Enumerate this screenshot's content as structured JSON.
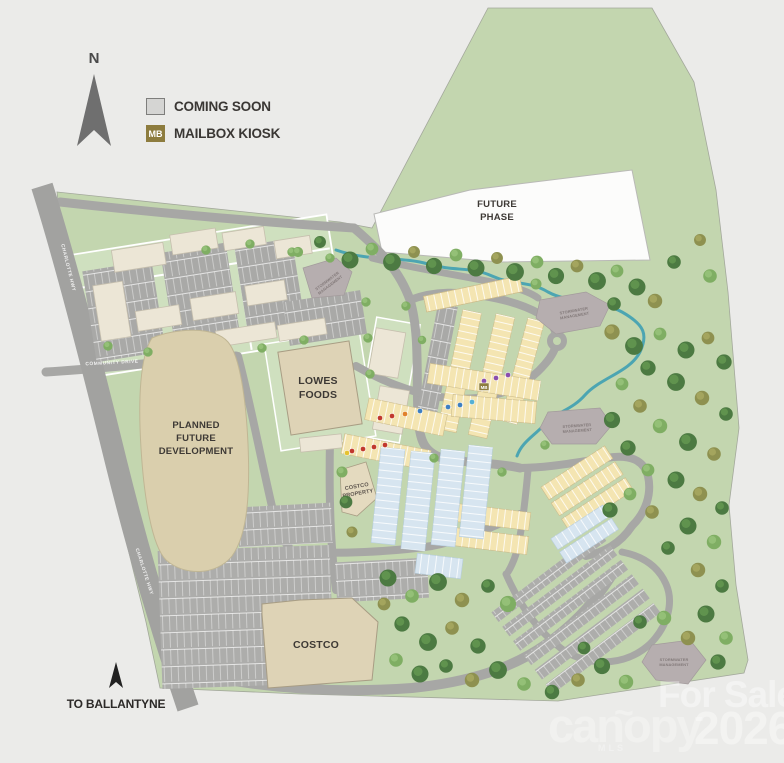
{
  "legend": {
    "north": "N",
    "coming_soon": "COMING SOON",
    "mailbox_kiosk": "MAILBOX KIOSK",
    "mb": "MB"
  },
  "labels": {
    "future_phase": [
      "FUTURE",
      "PHASE"
    ],
    "planned": [
      "PLANNED",
      "FUTURE",
      "DEVELOPMENT"
    ],
    "lowes": [
      "LOWES",
      "FOODS"
    ],
    "costco_property": [
      "COSTCO",
      "PROPERTY"
    ],
    "costco": "COSTCO",
    "stormwater": [
      "STORMWATER",
      "MANAGEMENT"
    ],
    "to_ballantyne": "TO BALLANTYNE"
  },
  "roads": {
    "highway": "CHARLOTTE HWY",
    "entrance": "COMMUNITY DRIVE"
  },
  "watermark": {
    "for_sale": "For Sale",
    "brand": "canopy",
    "brand_tilde": "~",
    "brand_sub": "MLS",
    "year": "2026"
  },
  "colors": {
    "background": "#ebebe9",
    "site_green": "#c3d6af",
    "block_green": "#cfe0bf",
    "road_gray": "#a7a7a5",
    "building_cream": "#ece6d6",
    "building_tan": "#ded3b6",
    "planned_tan": "#dacfad",
    "townhome_yellow": "#f4e5b2",
    "coming_soon_blue": "#d7e5f0",
    "coming_soon_gray": "#d5d5d3",
    "stormwater_gray": "#b6aeaf",
    "creek_teal": "#3fa0b2",
    "mailbox_gold": "#8d7c3e",
    "tree_green": "#4c7a42",
    "tree_olive": "#8e9150"
  }
}
